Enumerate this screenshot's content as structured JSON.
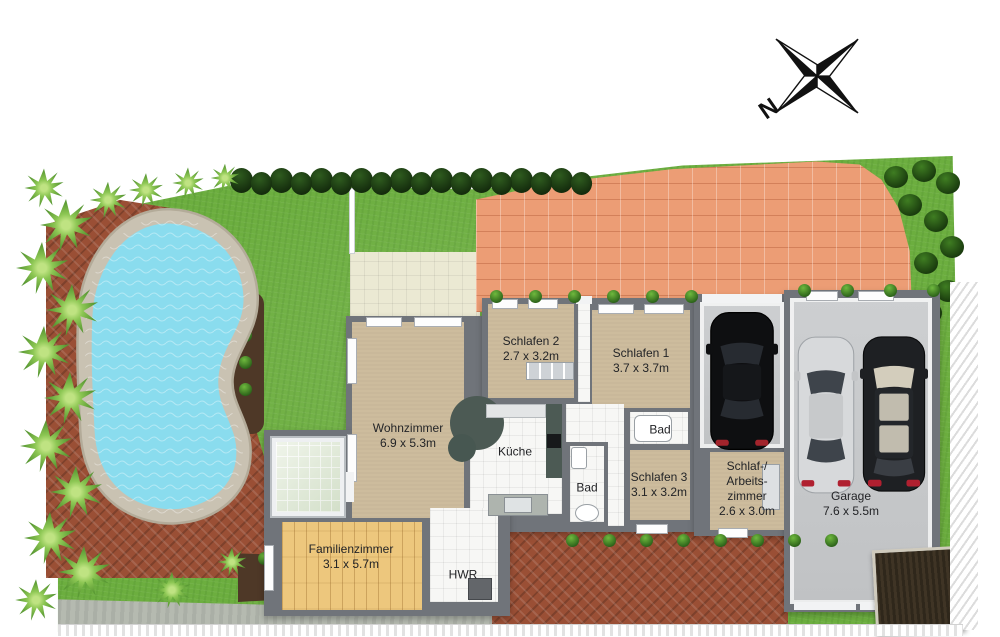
{
  "compass": {
    "north_label": "N"
  },
  "rooms": {
    "wohnzimmer": {
      "name": "Wohnzimmer",
      "dims": "6.9 x 5.3m"
    },
    "schlafen2": {
      "name": "Schlafen 2",
      "dims": "2.7 x 3.2m"
    },
    "schlafen1": {
      "name": "Schlafen 1",
      "dims": "3.7 x 3.7m"
    },
    "kueche": {
      "name": "Küche"
    },
    "bad_oben": {
      "name": "Bad"
    },
    "bad_mitte": {
      "name": "Bad"
    },
    "schlafen3": {
      "name": "Schlafen 3",
      "dims": "3.1 x 3.2m"
    },
    "schlaf_arbeitszimmer": {
      "line1": "Schlaf-/",
      "line2": "Arbeits-",
      "line3": "zimmer",
      "dims": "2.6 x 3.0m"
    },
    "garage": {
      "name": "Garage",
      "dims": "7.6 x 5.5m"
    },
    "familienzimmer": {
      "name": "Familienzimmer",
      "dims": "3.1 x 5.7m"
    },
    "hwr": {
      "name": "HWR"
    }
  },
  "colors": {
    "grass": "#6cae3f",
    "pool_water": "#8adcee",
    "pool_border": "#c9c2b2",
    "brick": "#9a4f35",
    "driveway": "#ec9d75",
    "patio": "#ebe9d3",
    "wall": "#70747a",
    "floor_tan": "#cdbc9d",
    "floor_wood": "#edc77d",
    "tile_white": "#f7f7f5",
    "garage_floor": "#c0c2c4",
    "glass": "#e3ecd9",
    "hedge": "#1d3a12",
    "soil": "#4e3827",
    "path_gray": "#b5bab0",
    "counter": "#4c5a54",
    "shed": "#3f3425"
  }
}
